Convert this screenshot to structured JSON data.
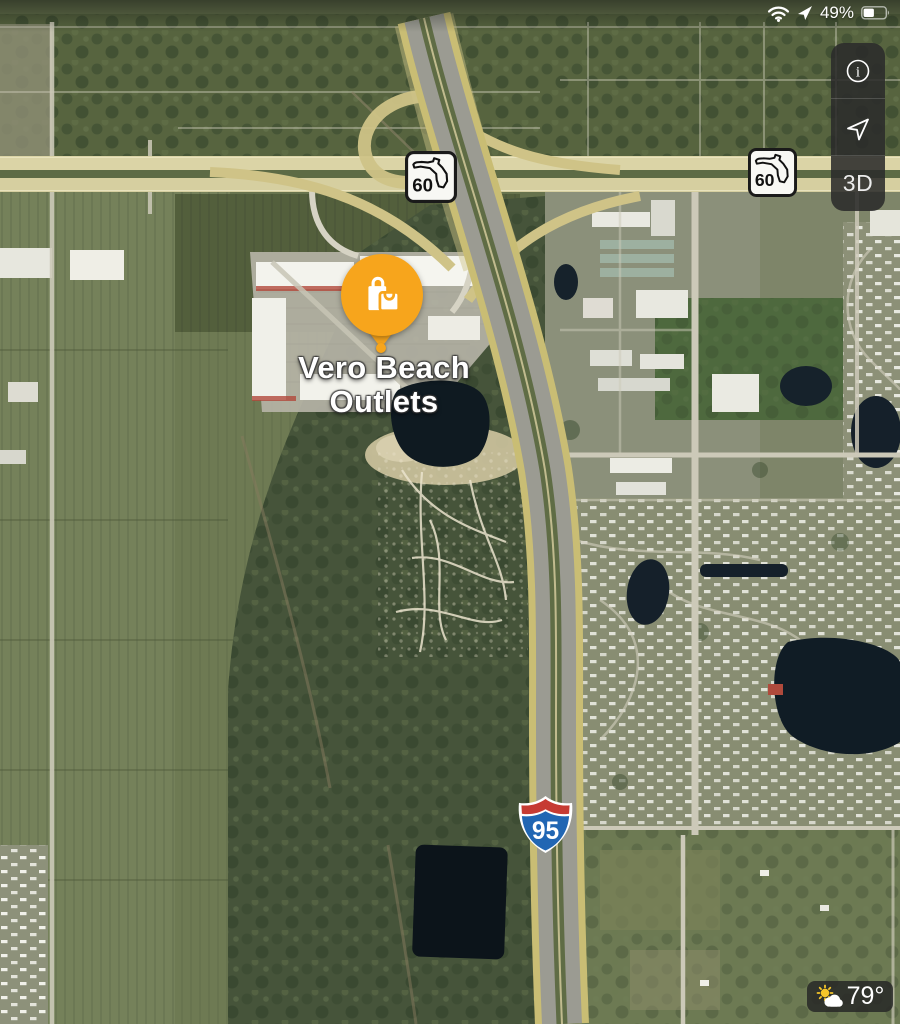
{
  "status_bar": {
    "battery_level": "49%",
    "icons": {
      "wifi": "wifi-icon",
      "location": "location-arrow-icon",
      "battery": "battery-icon"
    }
  },
  "map_controls": {
    "info_glyph": "i",
    "info_icon": "info-circle-icon",
    "locate_icon": "navigation-arrow-icon",
    "mode_3d_label": "3D"
  },
  "poi_marker": {
    "name_line1": "Vero Beach",
    "name_line2": "Outlets",
    "category_icon": "shopping-bags-icon",
    "pin_color": "#F7A51C"
  },
  "route_shields": {
    "florida_state_route": "60",
    "interstate": "95",
    "interstate_red": "#C63B33",
    "interstate_blue": "#2166B3"
  },
  "weather_widget": {
    "temperature": "79°",
    "condition_icon": "partly-cloudy-icon"
  }
}
